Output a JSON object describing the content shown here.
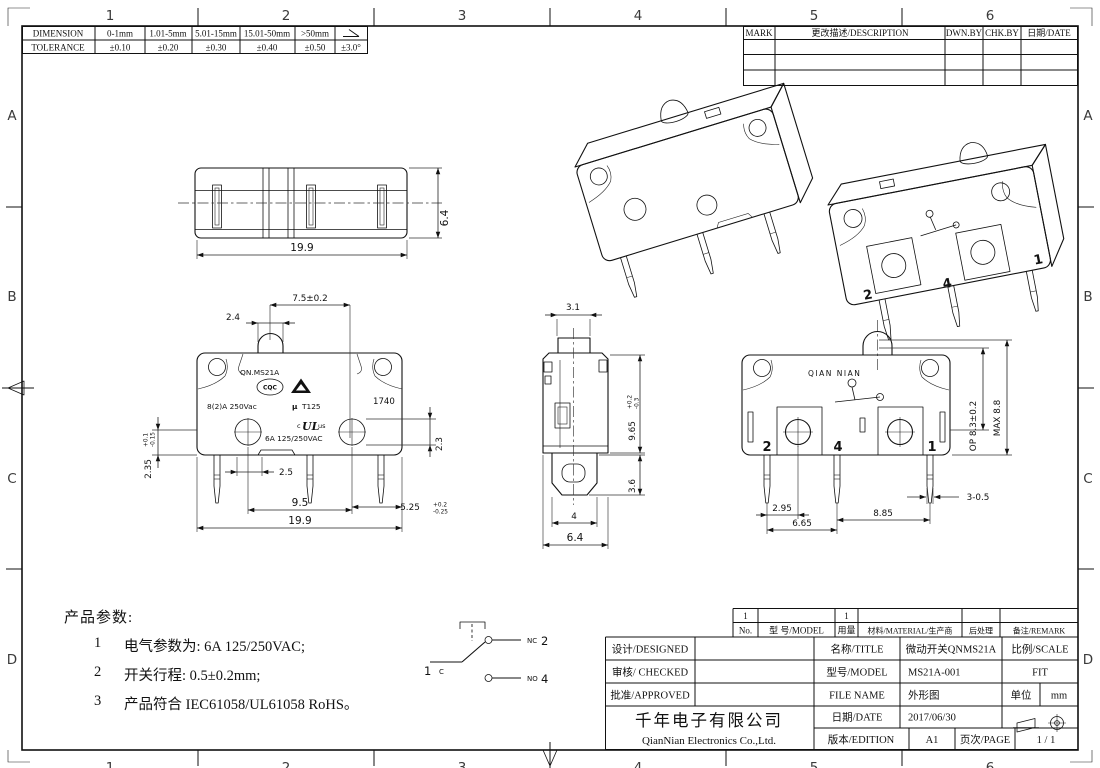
{
  "sheet": {
    "zone_cols": [
      "1",
      "2",
      "3",
      "4",
      "5",
      "6"
    ],
    "zone_rows": [
      "A",
      "B",
      "C",
      "D"
    ]
  },
  "tolerance_table": {
    "row1_label": "DIMENSION",
    "row2_label": "TOLERANCE",
    "ranges": [
      "0-1mm",
      "1.01-5mm",
      "5.01-15mm",
      "15.01-50mm",
      ">50mm"
    ],
    "angle_symbol": "∠",
    "values": [
      "±0.10",
      "±0.20",
      "±0.30",
      "±0.40",
      "±0.50",
      "±3.0°"
    ]
  },
  "revision_table": {
    "headers": [
      "MARK",
      "更改描述/DESCRIPTION",
      "DWN.BY",
      "CHK.BY",
      "日期/DATE"
    ]
  },
  "views": {
    "top_view": {
      "dim_width": "19.9",
      "dim_depth": "6.4"
    },
    "front_view": {
      "dim_actuator_offset": "7.5±0.2",
      "dim_actuator_width": "2.4",
      "dim_hole": "2.3",
      "dim_pin_exit": {
        "v": "2.35",
        "up": "+0.1",
        "dn": "-0.15"
      },
      "dim_pin_offset": "2.5",
      "dim_pin_pitch": "9.5",
      "dim_edge": {
        "v": "5.25",
        "up": "+0.2",
        "dn": "-0.25"
      },
      "dim_width": "19.9",
      "markings": {
        "model": "QN.MS21A",
        "cqc": "CQC",
        "rating_hi": "8(2)A 250Vac",
        "mu": "μ",
        "thermal": "T125",
        "date_code": "1740",
        "ul_c": "c",
        "ul": "UL",
        "ul_us": "us",
        "rating_lo": "6A 125/250VAC"
      }
    },
    "side_view": {
      "dim_actuator": "3.1",
      "dim_height": {
        "v": "9.65",
        "up": "+0.2",
        "dn": "-0.3"
      },
      "dim_terminal": "3.6",
      "dim_terminal_w": "4",
      "dim_depth": "6.4"
    },
    "back_view": {
      "brand": "QIAN NIAN",
      "terminal_nc": "2",
      "terminal_no": "4",
      "terminal_c": "1",
      "dim_op": "OP 8.3±0.2",
      "dim_max": "MAX 8.8",
      "dim_a": "2.95",
      "dim_b": "6.65",
      "dim_c": "8.85",
      "dim_pin": "3-0.5"
    }
  },
  "circuit": {
    "com_terminal": "1",
    "com_label": "C",
    "nc_label": "NC",
    "nc_terminal": "2",
    "no_label": "NO",
    "no_terminal": "4"
  },
  "notes": {
    "title": "产品参数:",
    "items": [
      {
        "no": "1",
        "text": "电气参数为: 6A 125/250VAC;"
      },
      {
        "no": "2",
        "text": "开关行程: 0.5±0.2mm;"
      },
      {
        "no": "3",
        "text": "产品符合 IEC61058/UL61058 RoHS。"
      }
    ]
  },
  "title_block": {
    "parts_no": "1",
    "parts_qty": "1",
    "parts_headers": [
      "No.",
      "型 号/MODEL",
      "用量",
      "材料/MATERIAL/生产商",
      "后处理",
      "备注/REMARK"
    ],
    "designed_label": "设计/DESIGNED",
    "checked_label": "审核/ CHECKED",
    "approved_label": "批准/APPROVED",
    "company_cn": "千年电子有限公司",
    "company_en": "QianNian Electronics Co.,Ltd.",
    "title_label": "名称/TITLE",
    "title_value": "微动开关QNMS21A",
    "model_label": "型号/MODEL",
    "model_value": "MS21A-001",
    "file_label": "FILE NAME",
    "file_value": "外形图",
    "scale_label": "比例/SCALE",
    "scale_value": "FIT",
    "unit_label": "单位",
    "unit_value": "mm",
    "date_label": "日期/DATE",
    "date_value": "2017/06/30",
    "edition_label": "版本/EDITION",
    "edition_value": "A1",
    "page_label": "页次/PAGE",
    "page_value": "1 / 1"
  }
}
